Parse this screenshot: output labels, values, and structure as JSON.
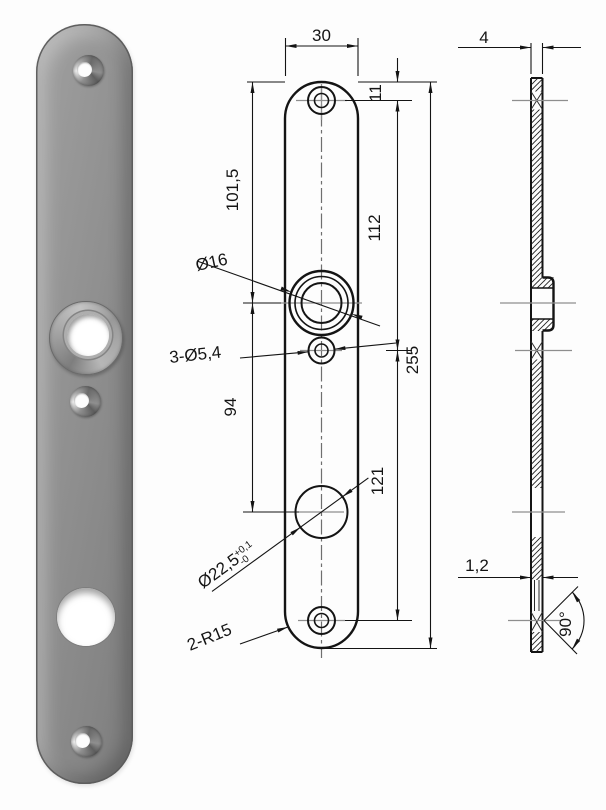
{
  "front_view": {
    "width": "30",
    "top_hole_offset": "11",
    "boss_center_from_top": "101,5",
    "screw_hole_spacing_top": "112",
    "boss_to_big_hole": "94",
    "screw_hole_spacing_bottom": "121",
    "total_length": "255",
    "boss_diameter": "Ø16",
    "screw_holes": "3-Ø5,4",
    "big_hole_diameter": "Ø22,5",
    "big_hole_tol_upper": "+0,1",
    "big_hole_tol_lower": "-0",
    "end_radius": "2-R15"
  },
  "side_view": {
    "overall_thickness": "4",
    "sheet_thickness": "1,2",
    "countersink_angle": "90°"
  }
}
